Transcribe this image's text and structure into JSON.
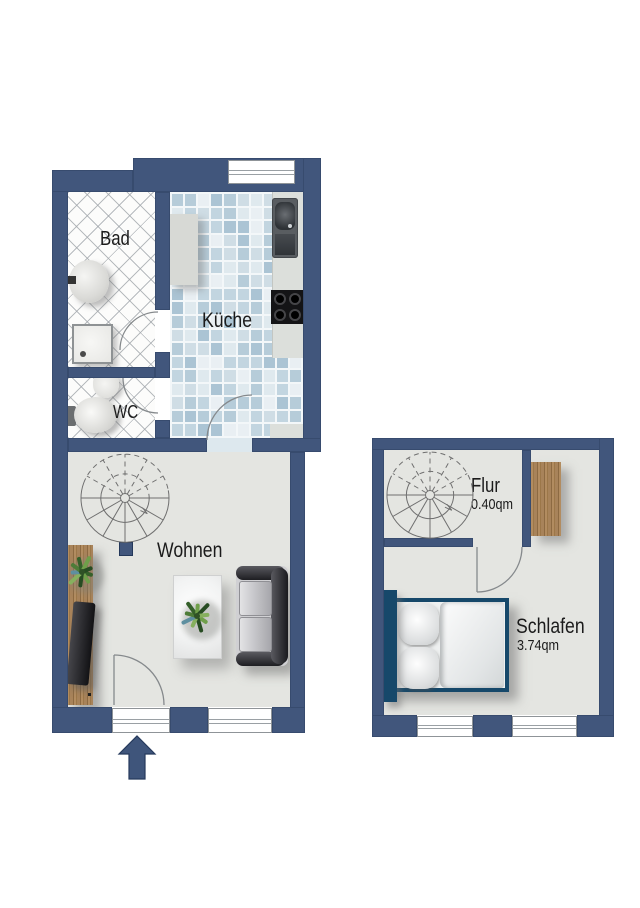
{
  "document": {
    "type": "floor-plan",
    "language": "de"
  },
  "colors": {
    "wall": "#41567c",
    "floor": "#e4e5e1",
    "tile_grout": "#f3f7f9",
    "tile_palette": [
      "#b6ccd9",
      "#cfdde5",
      "#dfe9ee",
      "#c2d5e0",
      "#e9eff3",
      "#abc4d4"
    ],
    "wood": "#a8835a",
    "bed_frame": "#16486a",
    "text": "#1b1b1b",
    "stair_line": "#6f6f6f",
    "arrow": "#3f557b"
  },
  "left_plan": {
    "name": "lower-level",
    "rooms": [
      {
        "id": "bad",
        "label": "Bad",
        "fixtures": [
          "bathroom-sink",
          "shower"
        ]
      },
      {
        "id": "wc",
        "label": "WC",
        "fixtures": [
          "wc-sink",
          "toilet"
        ]
      },
      {
        "id": "kueche",
        "label": "Küche",
        "fixtures": [
          "kitchen-cabinet",
          "kitchen-counter",
          "kitchen-sink-unit",
          "stove"
        ]
      },
      {
        "id": "wohnen",
        "label": "Wohnen",
        "fixtures": [
          "spiral-staircase",
          "column",
          "sideboard",
          "plant",
          "tv",
          "coffee-table",
          "plant",
          "sofa"
        ]
      }
    ],
    "windows": 3,
    "entrance": "arrow-up"
  },
  "right_plan": {
    "name": "upper-level",
    "rooms": [
      {
        "id": "flur",
        "label": "Flur",
        "area": "0.40qm",
        "fixtures": [
          "spiral-staircase",
          "wardrobe"
        ]
      },
      {
        "id": "schlafen",
        "label": "Schlafen",
        "area": "3.74qm",
        "fixtures": [
          "double-bed"
        ]
      }
    ],
    "windows": 2
  }
}
